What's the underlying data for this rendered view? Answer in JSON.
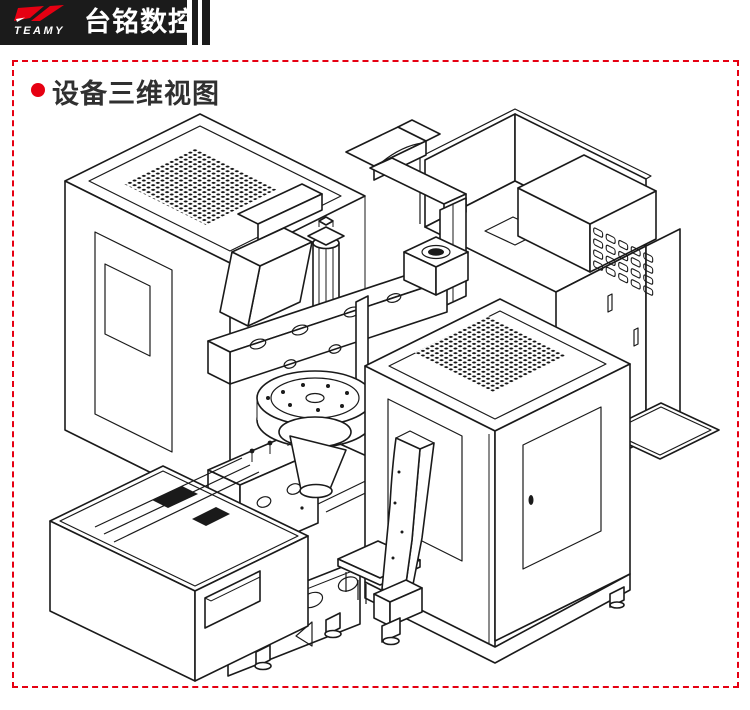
{
  "header": {
    "logo_text": "TEAMY",
    "logo_color": "#e60012",
    "brand_name": "台铭数控",
    "brand_color": "#ffffff",
    "bar_color": "#1b1b1b"
  },
  "section": {
    "title": "设备三维视图",
    "title_color": "#303030",
    "bullet_color": "#e60012",
    "border_color": "#e60012",
    "border_style": "dashed"
  },
  "diagram": {
    "type": "isometric-wireframe",
    "subject": "cnc-machine-3d-view",
    "line_color": "#1a1a1a",
    "background": "#ffffff",
    "features": [
      "left-enclosure-with-perforated-top",
      "right-enclosure-with-perforated-top-and-door",
      "rear-electrical-cabinet-with-vent-box",
      "overhead-gantry-arm",
      "spindle-beam-with-bolt-holes",
      "pneumatic-cylinder",
      "rotary-table-with-bolt-holes",
      "chip-bin-base",
      "machine-base-with-oval-holes-and-feet"
    ]
  }
}
